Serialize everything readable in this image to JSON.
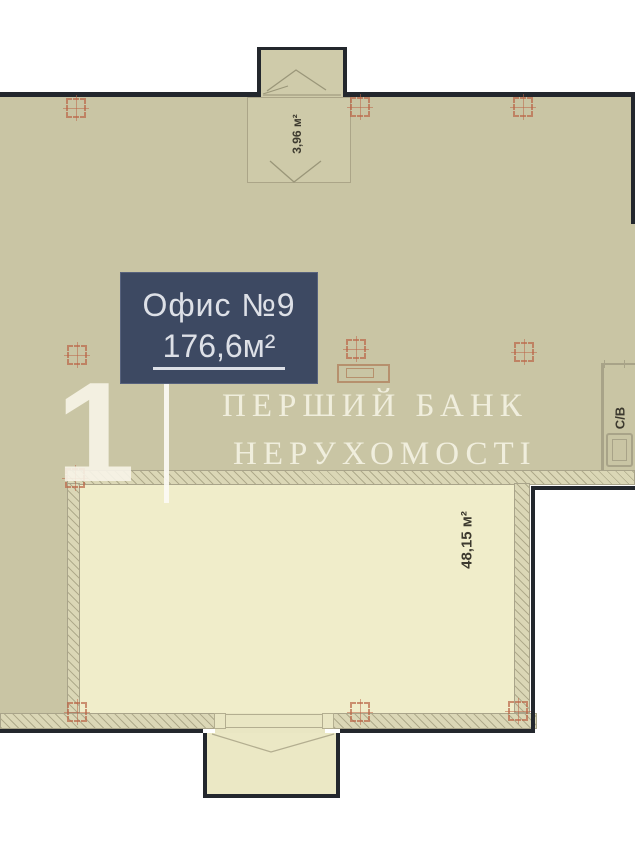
{
  "plan": {
    "unit_label": {
      "title": "Офис №9",
      "area": "176,6м²"
    },
    "rooms": [
      {
        "id": "top-annex",
        "area_label": "3,96 м²"
      },
      {
        "id": "hall",
        "area_label": "48,15 м²"
      },
      {
        "id": "bathroom",
        "label": "С/В"
      }
    ],
    "watermark": {
      "digit": "1",
      "line1": "ПЕРШИЙ БАНК",
      "line2": "НЕРУХОМОСТІ"
    },
    "colors": {
      "floor_main": "#c9c5a4",
      "floor_room": "#f0edca",
      "floor_balcony": "#ebe8c5",
      "wall_hatch": "#dbd7b6",
      "structure_dark": "#23272d",
      "grid_marker": "#bb6648",
      "label_box": "#3d4962",
      "label_text": "#dde0e7",
      "watermark_text": "#f7f4e8"
    }
  }
}
